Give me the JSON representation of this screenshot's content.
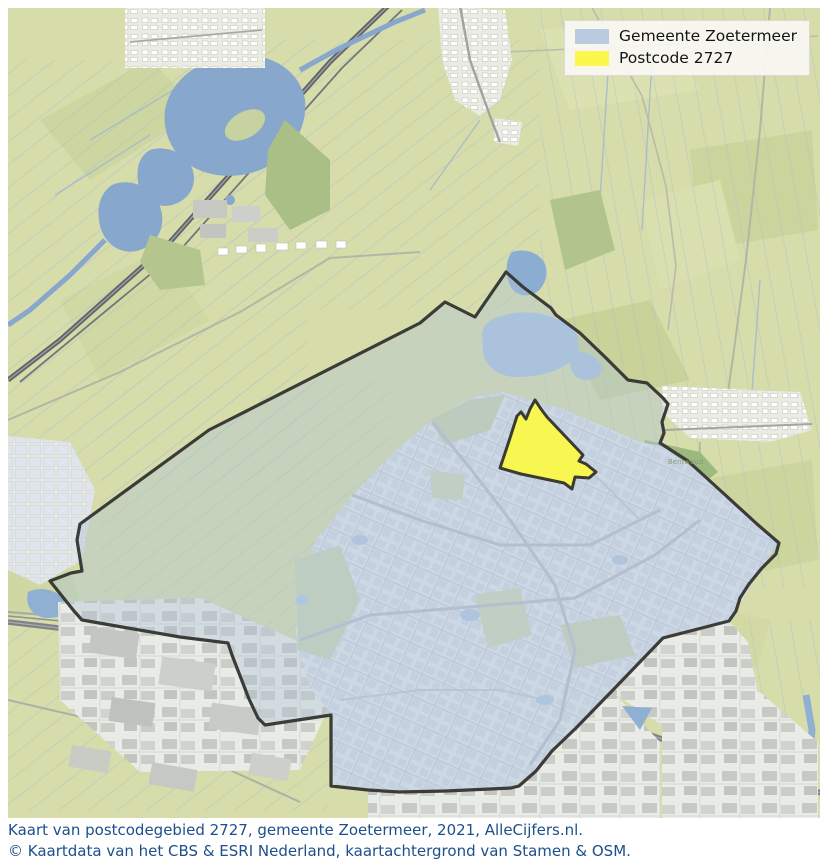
{
  "legend": {
    "items": [
      {
        "label": "Gemeente Zoetermeer",
        "color": "#b8cbe0"
      },
      {
        "label": "Postcode 2727",
        "color": "#fbf74d"
      }
    ]
  },
  "caption": {
    "line1": "Kaart van postcodegebied 2727, gemeente Zoetermeer, 2021, AlleCijfers.nl.",
    "line2": "© Kaartdata van het CBS & ESRI Nederland, kaartachtergrond van Stamen & OSM."
  },
  "map": {
    "boundary_color": "#3b3b37",
    "municipality_fill": "#b0c2d8",
    "highlight_fill": "#f8f651",
    "highlight_stroke": "#3b3b32",
    "water_color": "#87a7cd",
    "field_color": "#d6dcaa",
    "labels": [
      {
        "text": "Bentwoud"
      }
    ]
  }
}
